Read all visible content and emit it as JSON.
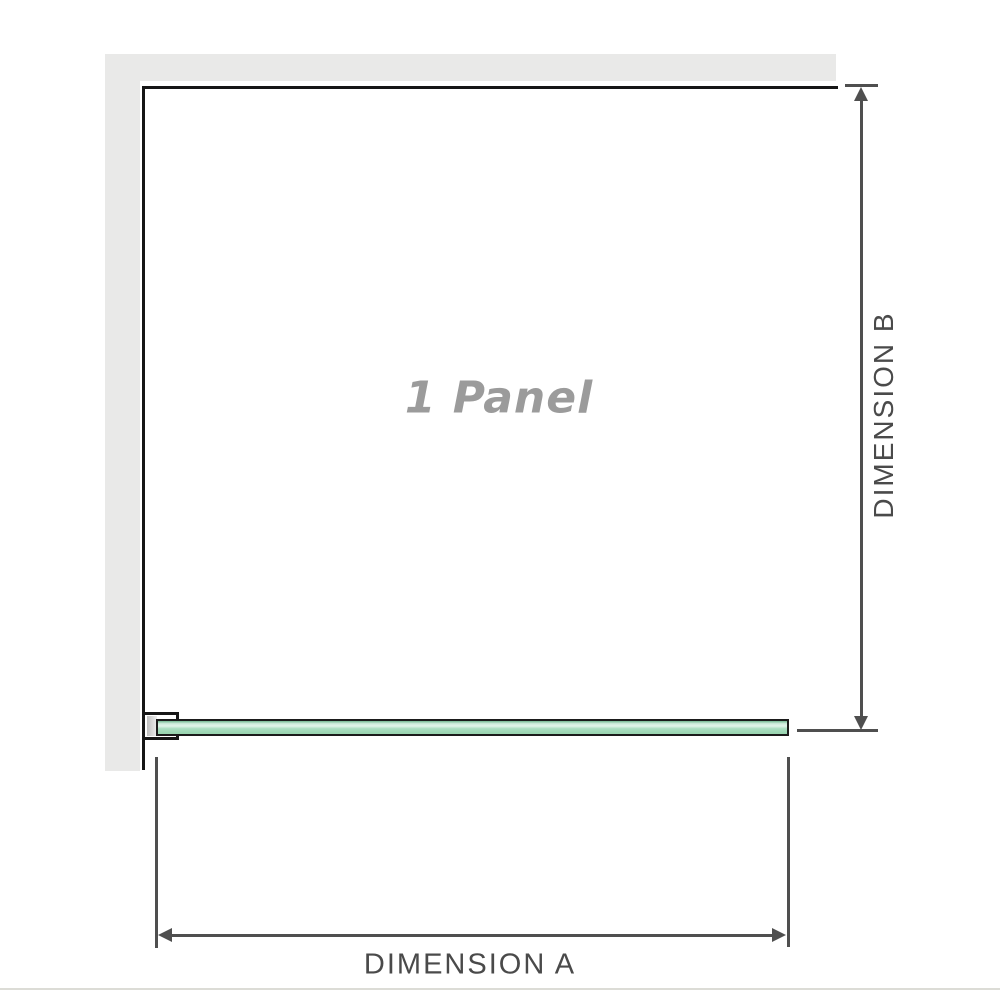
{
  "diagram": {
    "panel_label": "1 Panel",
    "dimensions": {
      "a_label": "DIMENSION A",
      "b_label": "DIMENSION B"
    },
    "colors": {
      "wall_gray": "#e9e9e8",
      "panel_border": "#161616",
      "glass_green": "#98d4ae",
      "glass_highlight": "#e2f4ea",
      "glass_border": "#1b1b1b",
      "dimension_line": "#4f4f4f",
      "dimension_text": "#4a4a4a",
      "panel_label_color": "#9b9b9b",
      "footer_divider": "#dcdcd6"
    }
  }
}
